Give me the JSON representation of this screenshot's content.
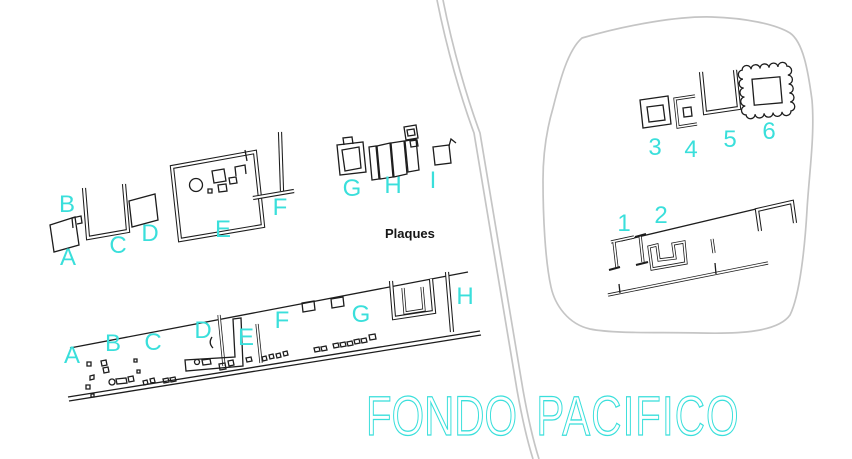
{
  "title": {
    "left_word": "FONDO",
    "right_word": "PACIFICO"
  },
  "annotations": {
    "plaques": "Plaques"
  },
  "colors": {
    "label_cyan": "#3adfdb",
    "ink": "#1d1d1d",
    "road_gray": "#c5c5c5"
  },
  "upper_site": {
    "labels": [
      "A",
      "B",
      "C",
      "D",
      "E",
      "F",
      "G",
      "H",
      "I"
    ]
  },
  "lower_site": {
    "labels": [
      "A",
      "B",
      "C",
      "D",
      "E",
      "F",
      "G",
      "H"
    ]
  },
  "pacifico_site": {
    "labels": [
      "1",
      "2",
      "3",
      "4",
      "5",
      "6"
    ]
  }
}
